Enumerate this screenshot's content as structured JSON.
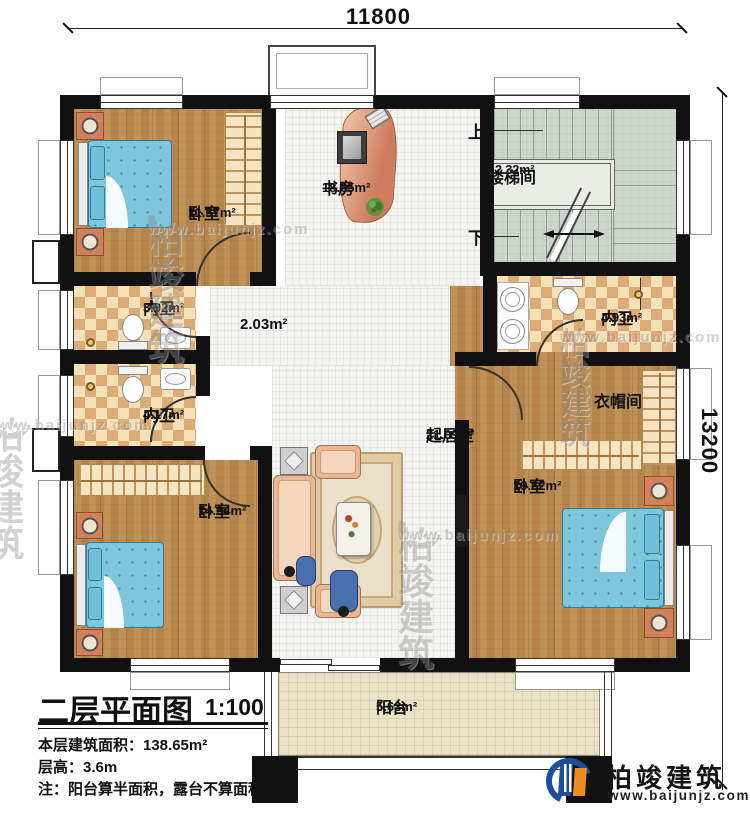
{
  "dimensions": {
    "top": "11800",
    "right": "13200"
  },
  "stairs": {
    "up": "上",
    "down": "下"
  },
  "rooms": {
    "bedroom_tl": {
      "label": "卧室",
      "area": "11.57m²"
    },
    "study": {
      "label": "书房",
      "area": "18.65m²"
    },
    "stairwell": {
      "label": "楼梯间",
      "area": "12.32m²"
    },
    "bath_tl": {
      "label": "内卫",
      "area": "3.92m²"
    },
    "bath_bl": {
      "label": "内卫",
      "area": "4.17m²"
    },
    "bath_r": {
      "label": "内卫",
      "area": "4.93m²"
    },
    "hall": {
      "area": "2.03m²"
    },
    "cloakroom": {
      "label": "衣帽间"
    },
    "living": {
      "label": "起居室",
      "area": "21.09m²"
    },
    "bedroom_bl": {
      "label": "卧室",
      "area": "14.94m²"
    },
    "bedroom_br": {
      "label": "卧室",
      "area": "19.62m²"
    },
    "balcony": {
      "label": "阳台",
      "area": "5.63m²"
    }
  },
  "title_block": {
    "title": "二层平面图",
    "scale": "1:100",
    "area_line": "本层建筑面积：138.65m²",
    "height_line": "层高：3.6m",
    "note_line": "注：阳台算半面积，露台不算面积"
  },
  "brand": {
    "name": "柏竣建筑",
    "website": "www.baijunjz.com"
  },
  "watermark": {
    "name": "柏竣建筑",
    "website": "www.baijunjz.com"
  }
}
